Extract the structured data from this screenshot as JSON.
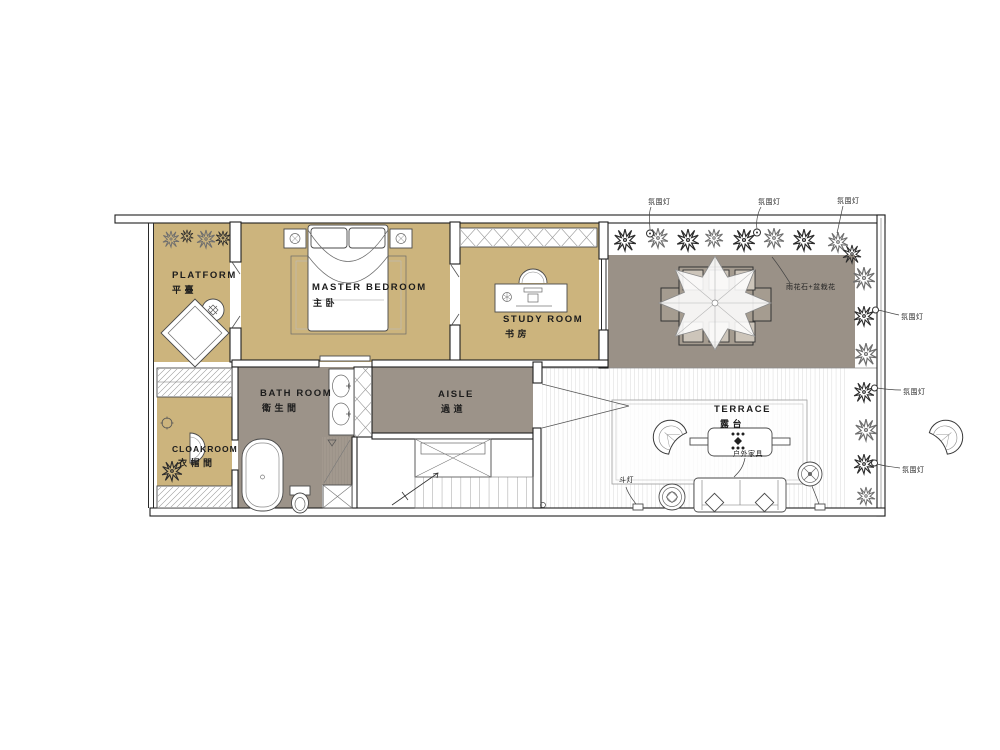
{
  "plan": {
    "rooms": {
      "platform": {
        "en": "PLATFORM",
        "cn": "平臺"
      },
      "master_bedroom": {
        "en": "MASTER BEDROOM",
        "cn": "主卧"
      },
      "study_room": {
        "en": "STUDY ROOM",
        "cn": "书房"
      },
      "bath_room": {
        "en": "BATH ROOM",
        "cn": "衛生間"
      },
      "cloakroom": {
        "en": "CLOAKROOM",
        "cn": "衣帽間"
      },
      "aisle": {
        "en": "AISLE",
        "cn": "過道"
      },
      "terrace": {
        "en": "TERRACE",
        "cn": "露台"
      }
    },
    "annotations": {
      "ambient_light": "氛围灯",
      "pebbles_potted": "雨花石+盆栽花",
      "outdoor_furniture": "户外家具",
      "spot_light": "斗灯"
    },
    "colors": {
      "room_fill": "#ccb47d",
      "corridor_fill": "#9c9389",
      "garden_fill": "#9a9187",
      "wall": "#1f1f1f"
    }
  }
}
